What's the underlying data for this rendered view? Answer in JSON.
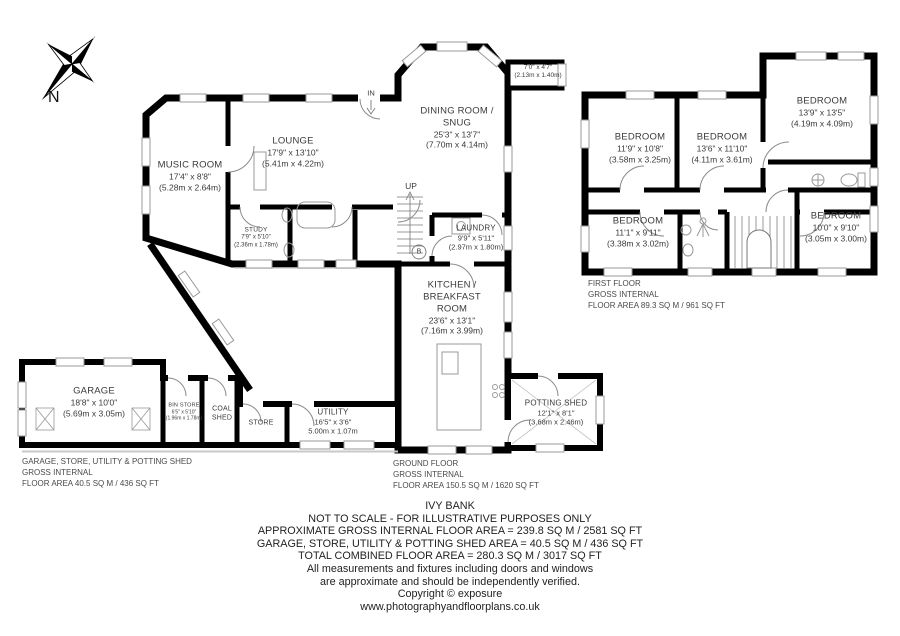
{
  "title": "IVY BANK",
  "palette": {
    "wall": "#000000",
    "label_text": "#3a3a3a",
    "note_text": "#4a4a4a",
    "fixture": "#999999",
    "window": "#9a9a9a"
  },
  "compass": {
    "north_label": "N"
  },
  "ground_floor": {
    "rooms": {
      "music_room": {
        "name": "MUSIC ROOM",
        "imperial": "17'4\" x 8'8\"",
        "metric": "(5.28m x 2.64m)"
      },
      "lounge": {
        "name": "LOUNGE",
        "imperial": "17'9\" x 13'10\"",
        "metric": "(5.41m x 4.22m)"
      },
      "dining_snug": {
        "name": "DINING ROOM / SNUG",
        "imperial": "25'3\" x 13'7\"",
        "metric": "(7.70m x 4.14m)"
      },
      "study": {
        "name": "STUDY",
        "imperial": "7'9\" x 5'10\"",
        "metric": "(2.36m x 1.78m)"
      },
      "laundry": {
        "name": "LAUNDRY",
        "imperial": "9'9\" x 5'11\"",
        "metric": "(2.97m x 1.80m)"
      },
      "kitchen": {
        "name": "KITCHEN / BREAKFAST ROOM",
        "imperial": "23'6\" x 13'1\"",
        "metric": "(7.16m x 3.99m)"
      },
      "utility": {
        "name": "UTILITY",
        "imperial": "16'5\" x 3'6\"",
        "metric": "5.00m x 1.07m"
      },
      "garage": {
        "name": "GARAGE",
        "imperial": "18'8\" x 10'0\"",
        "metric": "(5.69m x 3.05m)"
      },
      "bin_store": {
        "name": "BIN STORE",
        "imperial": "6'5\" x 5'10\"",
        "metric": "(1.96m x 1.78m)"
      },
      "coal_shed": {
        "name": "COAL SHED"
      },
      "store": {
        "name": "STORE"
      },
      "potting_shed": {
        "name": "POTTING SHED",
        "imperial": "12'1\" x 8'1\"",
        "metric": "(3.68m x 2.46m)"
      }
    },
    "annotations": {
      "up": "UP",
      "in": "IN",
      "boiler": "B",
      "recess": {
        "imperial": "7'0\" x 4'7\"",
        "metric": "(2.13m x 1.40m)"
      }
    },
    "area_note": [
      "GROUND FLOOR",
      "GROSS INTERNAL",
      "FLOOR AREA 150.5 SQ M / 1620 SQ FT"
    ]
  },
  "first_floor": {
    "rooms": {
      "bedroom1": {
        "name": "BEDROOM",
        "imperial": "11'9\" x 10'8\"",
        "metric": "(3.58m x 3.25m)"
      },
      "bedroom2": {
        "name": "BEDROOM",
        "imperial": "13'6\" x 11'10\"",
        "metric": "(4.11m x 3.61m)"
      },
      "bedroom3": {
        "name": "BEDROOM",
        "imperial": "13'9\" x 13'5\"",
        "metric": "(4.19m x 4.09m)"
      },
      "bedroom4": {
        "name": "BEDROOM",
        "imperial": "11'1\" x 9'11\"",
        "metric": "(3.38m x 3.02m)"
      },
      "bedroom5": {
        "name": "BEDROOM",
        "imperial": "10'0\" x 9'10\"",
        "metric": "(3.05m x 3.00m)"
      }
    },
    "area_note": [
      "FIRST FLOOR",
      "GROSS INTERNAL",
      "FLOOR AREA 89.3 SQ M / 961 SQ FT"
    ]
  },
  "annex_area_note": [
    "GARAGE, STORE, UTILITY & POTTING SHED",
    "GROSS INTERNAL",
    "FLOOR AREA 40.5 SQ M / 436 SQ FT"
  ],
  "footer": {
    "title": "IVY BANK",
    "lines": [
      "NOT TO SCALE - FOR ILLUSTRATIVE PURPOSES ONLY",
      "APPROXIMATE GROSS INTERNAL FLOOR AREA = 239.8 SQ M / 2581 SQ FT",
      "GARAGE, STORE, UTILITY & POTTING SHED AREA = 40.5 SQ M / 436 SQ FT",
      "TOTAL COMBINED FLOOR AREA = 280.3 SQ M / 3017 SQ FT",
      "All measurements and fixtures including doors and windows",
      "are approximate and should be independently verified.",
      "Copyright ©  exposure",
      "www.photographyandfloorplans.co.uk"
    ]
  }
}
